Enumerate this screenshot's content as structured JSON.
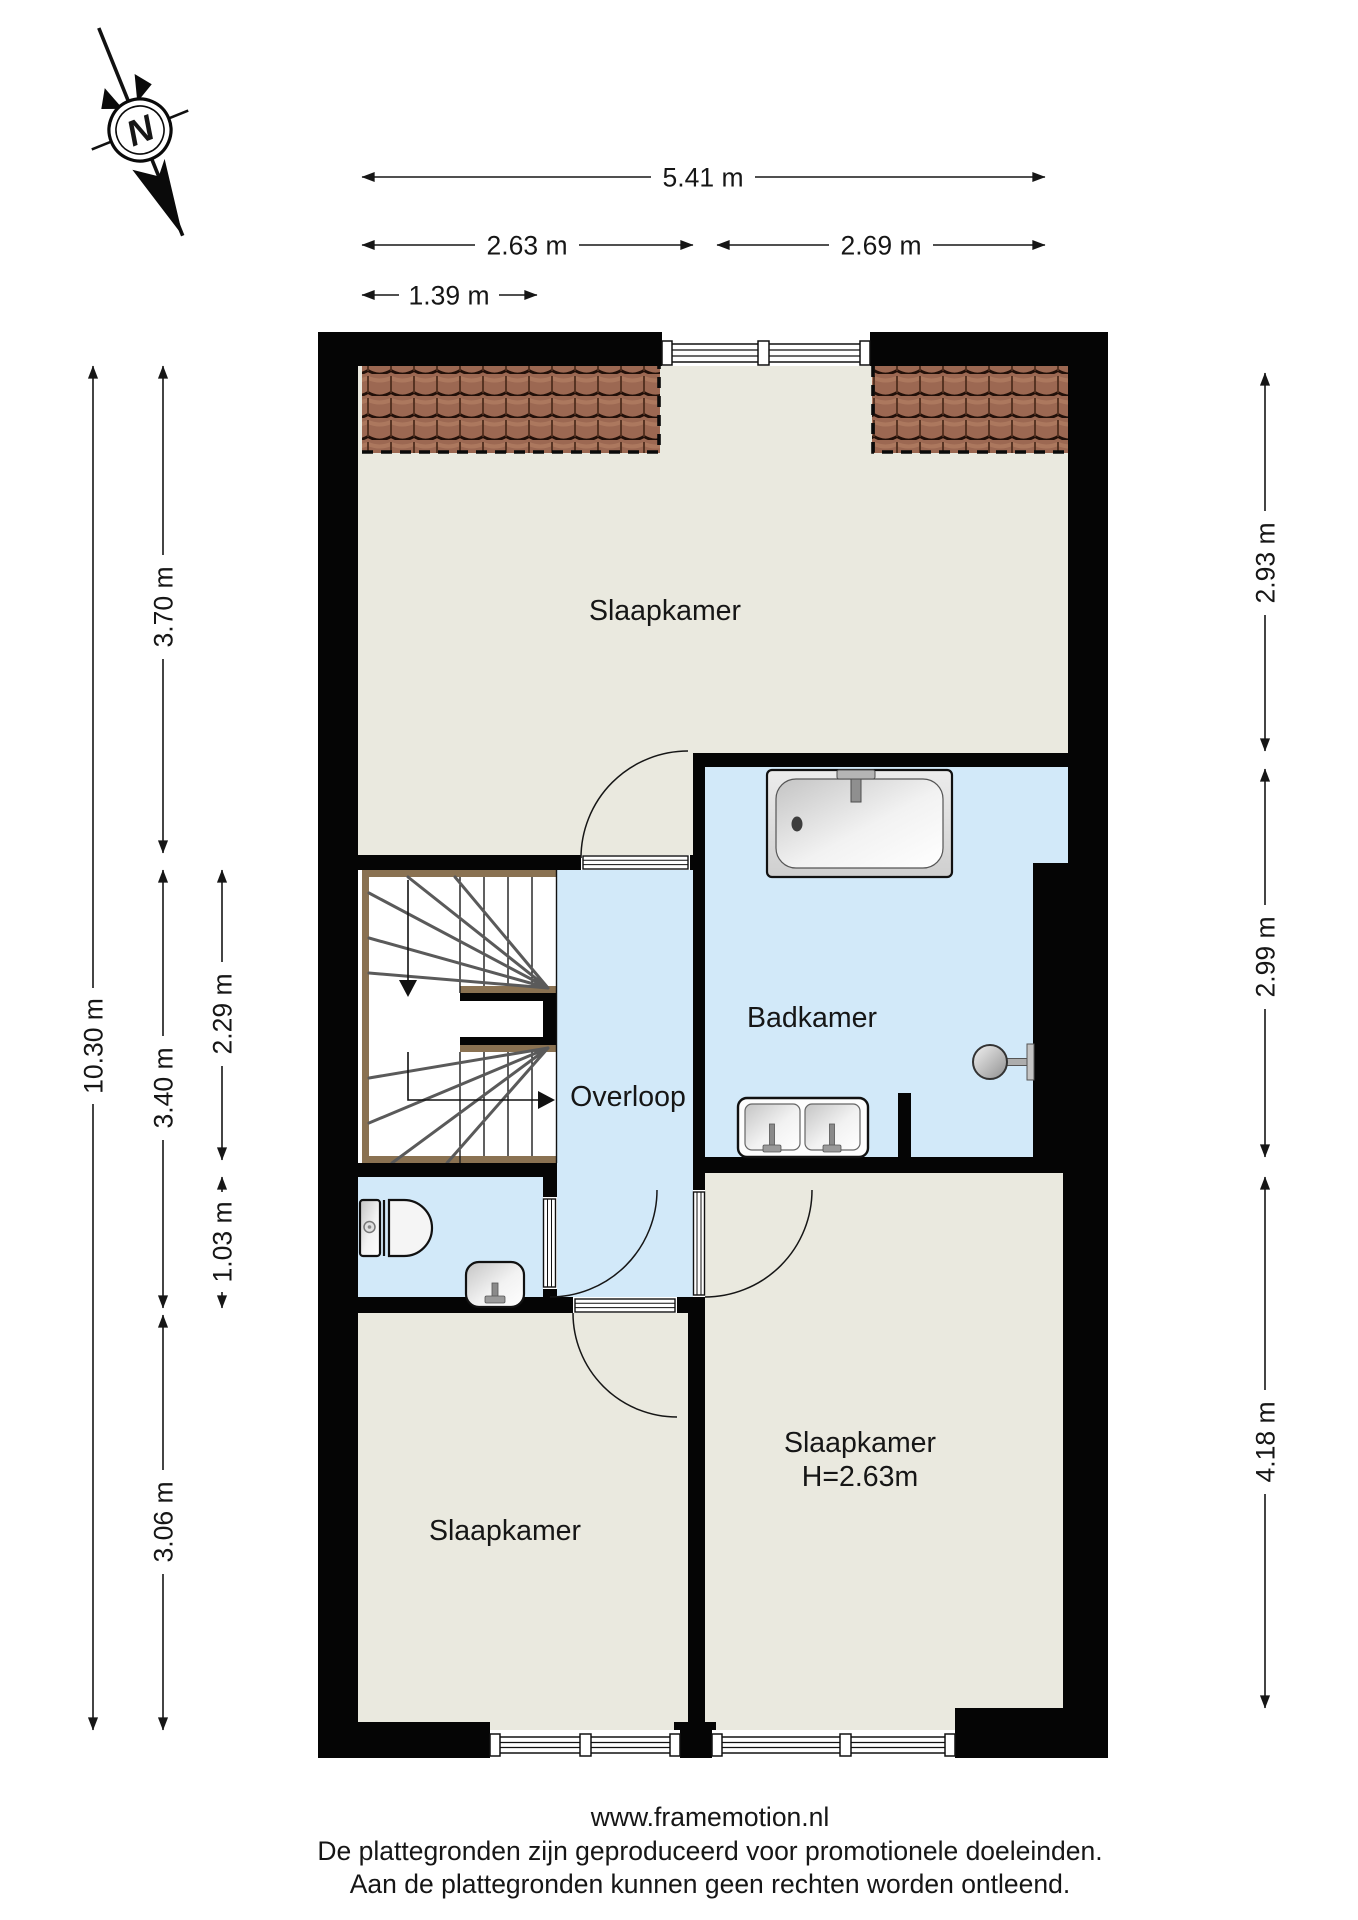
{
  "compass": {
    "label": "N"
  },
  "rooms": {
    "slaapkamer_top": {
      "label": "Slaapkamer"
    },
    "badkamer": {
      "label": "Badkamer"
    },
    "overloop": {
      "label": "Overloop"
    },
    "slaapkamer_bottom_left": {
      "label": "Slaapkamer"
    },
    "slaapkamer_bottom_right": {
      "label": "Slaapkamer",
      "height_note": "H=2.63m"
    }
  },
  "dimensions": {
    "top": {
      "total_width": "5.41 m",
      "left_span": "2.63 m",
      "right_span": "2.69 m",
      "partial_span": "1.39 m"
    },
    "left": {
      "total_height": "10.30 m",
      "top_room": "3.70 m",
      "middle_zone": "3.40 m",
      "bottom_room": "3.06 m",
      "stairs_zone": "2.29 m",
      "wc_zone": "1.03 m"
    },
    "right": {
      "top_room": "2.93 m",
      "bathroom": "2.99 m",
      "bottom_room": "4.18 m"
    }
  },
  "footer": {
    "website": "www.framemotion.nl",
    "disclaimer_line1": "De plattegronden zijn geproduceerd voor promotionele doeleinden.",
    "disclaimer_line2": "Aan de plattegronden kunnen geen rechten worden ontleend."
  },
  "colors": {
    "wall": "#050505",
    "dry_room_floor": "#eae9df",
    "wet_room_floor": "#d2e9f9",
    "roof_tile": "#9c6852",
    "stair_trim": "#8a7252"
  }
}
